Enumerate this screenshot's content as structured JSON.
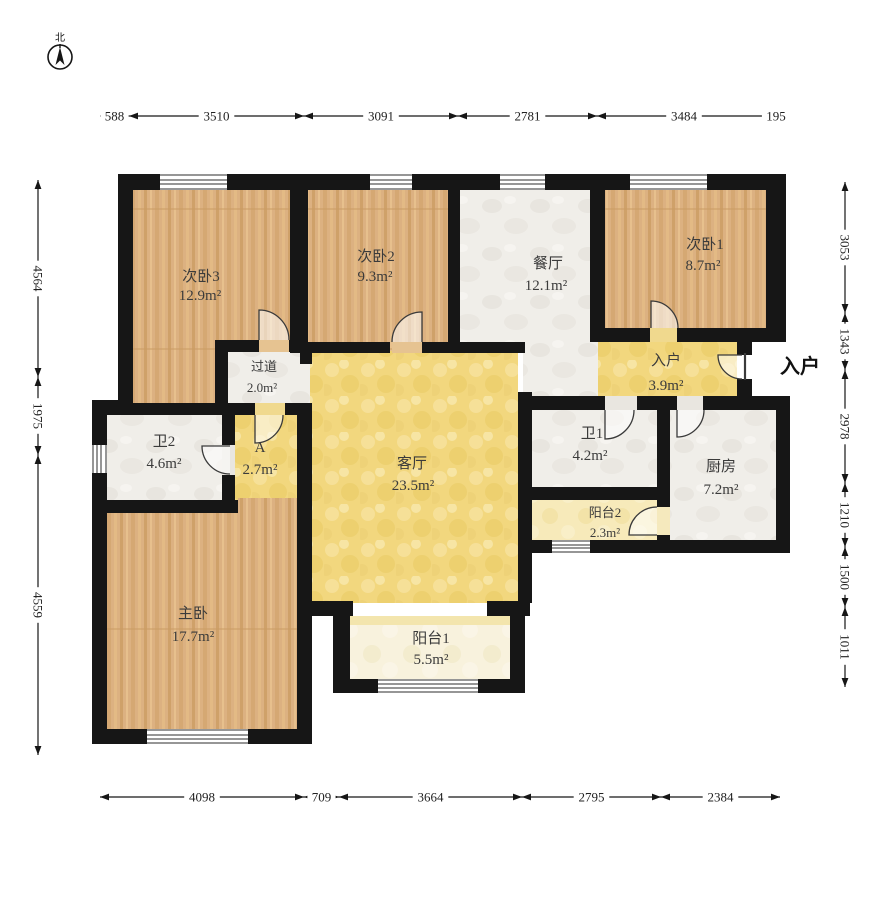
{
  "compass": {
    "label": "北"
  },
  "entrance_label": "入户",
  "rooms": [
    {
      "id": "bed3",
      "name": "次卧3",
      "area": "12.9m²"
    },
    {
      "id": "bed2",
      "name": "次卧2",
      "area": "9.3m²"
    },
    {
      "id": "dining",
      "name": "餐厅",
      "area": "12.1m²"
    },
    {
      "id": "bed1",
      "name": "次卧1",
      "area": "8.7m²"
    },
    {
      "id": "hallway",
      "name": "过道",
      "area": "2.0m²"
    },
    {
      "id": "entry",
      "name": "入户",
      "area": "3.9m²"
    },
    {
      "id": "bath2",
      "name": "卫2",
      "area": "4.6m²"
    },
    {
      "id": "roomA",
      "name": "A",
      "area": "2.7m²"
    },
    {
      "id": "living",
      "name": "客厅",
      "area": "23.5m²"
    },
    {
      "id": "bath1",
      "name": "卫1",
      "area": "4.2m²"
    },
    {
      "id": "kitchen",
      "name": "厨房",
      "area": "7.2m²"
    },
    {
      "id": "balcony2",
      "name": "阳台2",
      "area": "2.3m²"
    },
    {
      "id": "master",
      "name": "主卧",
      "area": "17.7m²"
    },
    {
      "id": "balcony1",
      "name": "阳台1",
      "area": "5.5m²"
    }
  ],
  "dimensions": {
    "top": [
      "588",
      "3510",
      "3091",
      "2781",
      "3484",
      "195"
    ],
    "bottom": [
      "4098",
      "709",
      "3664",
      "2795",
      "2384"
    ],
    "left": [
      "4564",
      "1975",
      "4559"
    ],
    "right": [
      "3053",
      "1343",
      "2978",
      "1210",
      "1500",
      "1011"
    ]
  },
  "colors": {
    "wall": "#161616",
    "wood": "#dcb181",
    "marble": "#f0eee9",
    "gold": "#f2d77e",
    "pale": "#f7eaba",
    "cream": "#f8f2dd"
  }
}
